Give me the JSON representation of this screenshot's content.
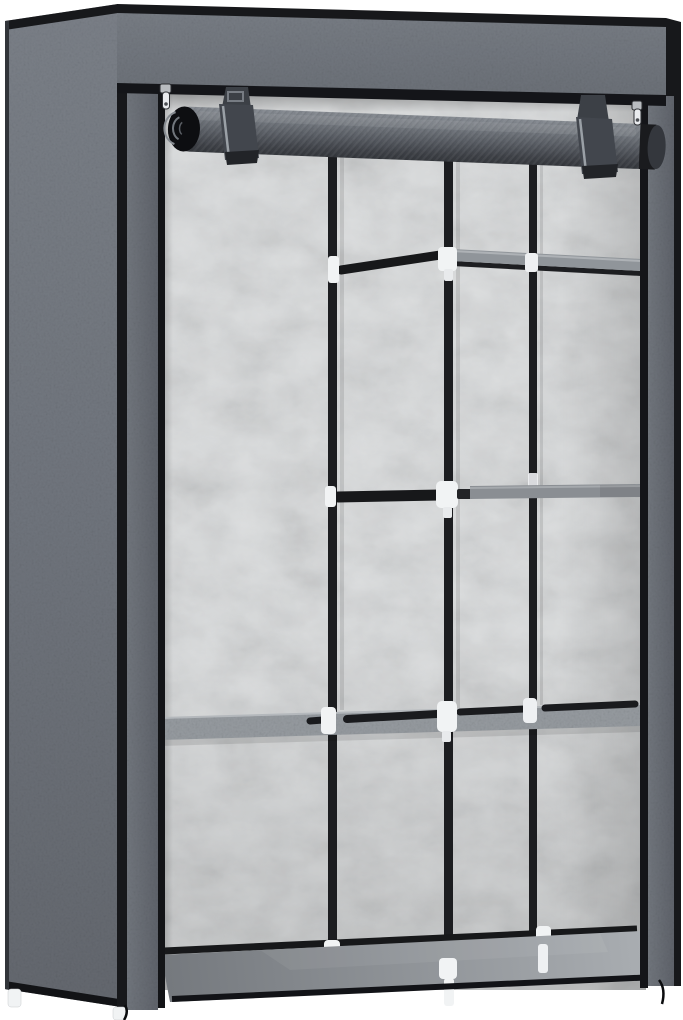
{
  "scene": {
    "kind": "product-photo",
    "subject": "Portable non-woven fabric wardrobe with roll-up front cover",
    "background_color": "#ffffff",
    "view": "three-quarter front view with the front cover rolled up, interior shelving visible"
  },
  "product": {
    "color_name": "grey",
    "components": {
      "top_cover_box": "fabric-covered top section with black trim",
      "rolled_door": "roll-up front door held by two fabric straps",
      "strap_count": 2,
      "zipper_count": 2,
      "side_panel": "left grey fabric side panel",
      "back_panel": "light mottled non-woven back panel",
      "poles": "three vertical black poles",
      "connectors": "white plastic connectors",
      "shelves": "upper-right shelf, middle-right shelf, full-width middle shelf, bottom shelf",
      "hanging_rods": "two short black rods in middle bay",
      "feet": "white plastic feet",
      "cords": "black zipper cords at bottom corners"
    }
  },
  "palette": {
    "background": "#ffffff",
    "side_panel": "#6e737b",
    "frame_fabric": "#676c74",
    "top_box": "#747980",
    "roll_dark": "#54585f",
    "trim_black": "#17181b",
    "pole_black": "#1c1d20",
    "back_panel": "#d7d9da",
    "shelf_fabric": "#969ba0",
    "shelf_edge": "#8a8e93",
    "bottom_shelf": "#8d9196",
    "connector_white": "#f1f3f4",
    "strap": "#42464d",
    "zipper_silver": "#e9ebee"
  }
}
